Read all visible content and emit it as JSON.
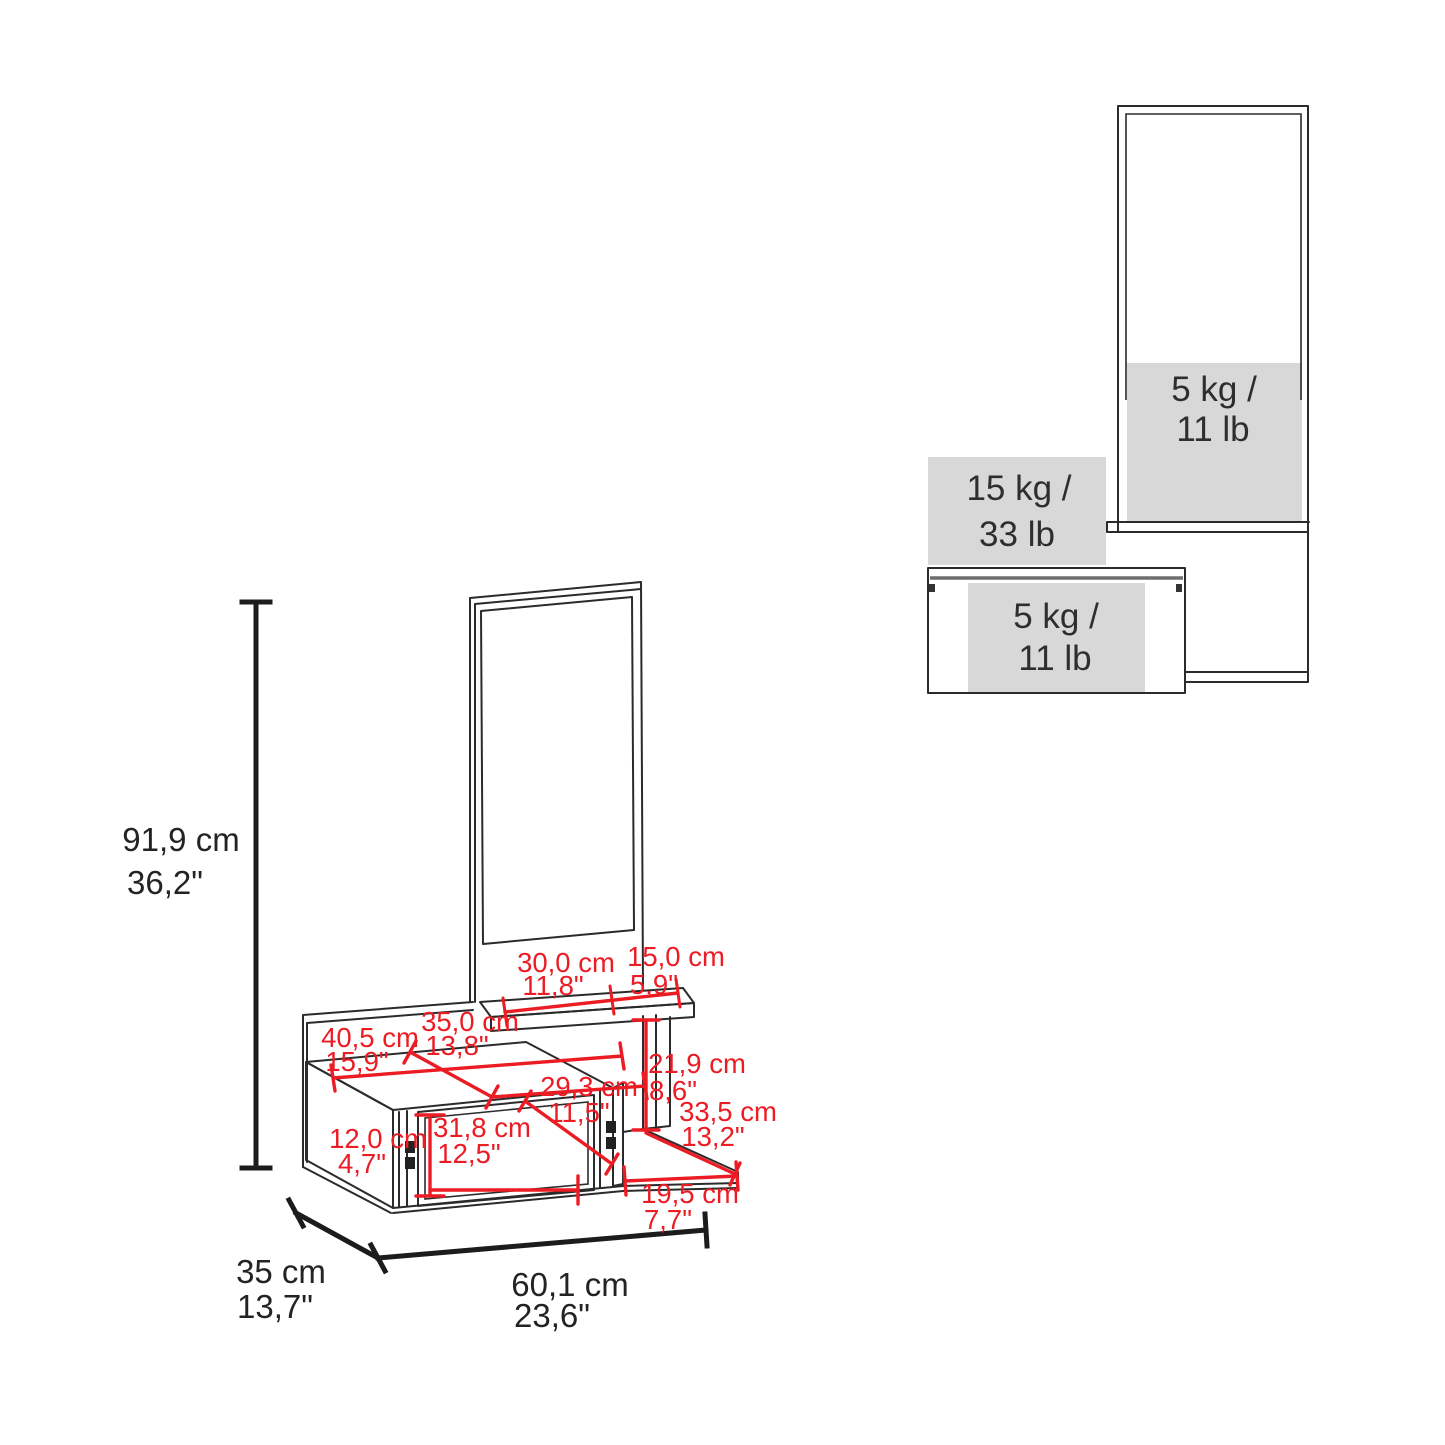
{
  "colors": {
    "dimension_red": "#ec1c24",
    "line_black": "#2b2b2b",
    "capacity_gray": "#d8d8d8"
  },
  "side_view": {
    "mirror_capacity_line1": "5 kg /",
    "mirror_capacity_line2": "11 lb",
    "top_shelf_capacity_line1": "15 kg /",
    "top_shelf_capacity_line2": "33 lb",
    "drawer_capacity_line1": "5 kg /",
    "drawer_capacity_line2": "11 lb"
  },
  "dimensions": {
    "height": {
      "cm": "91,9 cm",
      "in": "36,2\""
    },
    "depth": {
      "cm": "35 cm",
      "in": "13,7\""
    },
    "width": {
      "cm": "60,1 cm",
      "in": "23,6\""
    },
    "shelf_left": {
      "cm": "30,0 cm",
      "in": "11,8\""
    },
    "shelf_right": {
      "cm": "15,0 cm",
      "in": "5,9\""
    },
    "top_depth": {
      "cm": "35,0 cm",
      "in": "13,8\""
    },
    "top_width": {
      "cm": "40,5 cm",
      "in": "15,9\""
    },
    "shelf_gap_height": {
      "cm": "21,9 cm",
      "in": "8,6\""
    },
    "drawer_opening": {
      "cm": "29,3 cm",
      "in": "11,5\""
    },
    "side_shelf_diagonal": {
      "cm": "33,5 cm",
      "in": "13,2\""
    },
    "drawer_front_width": {
      "cm": "31,8 cm",
      "in": "12,5\""
    },
    "drawer_front_height": {
      "cm": "12,0 cm",
      "in": "4,7\""
    },
    "side_shelf_width": {
      "cm": "19,5 cm",
      "in": "7,7\""
    }
  }
}
